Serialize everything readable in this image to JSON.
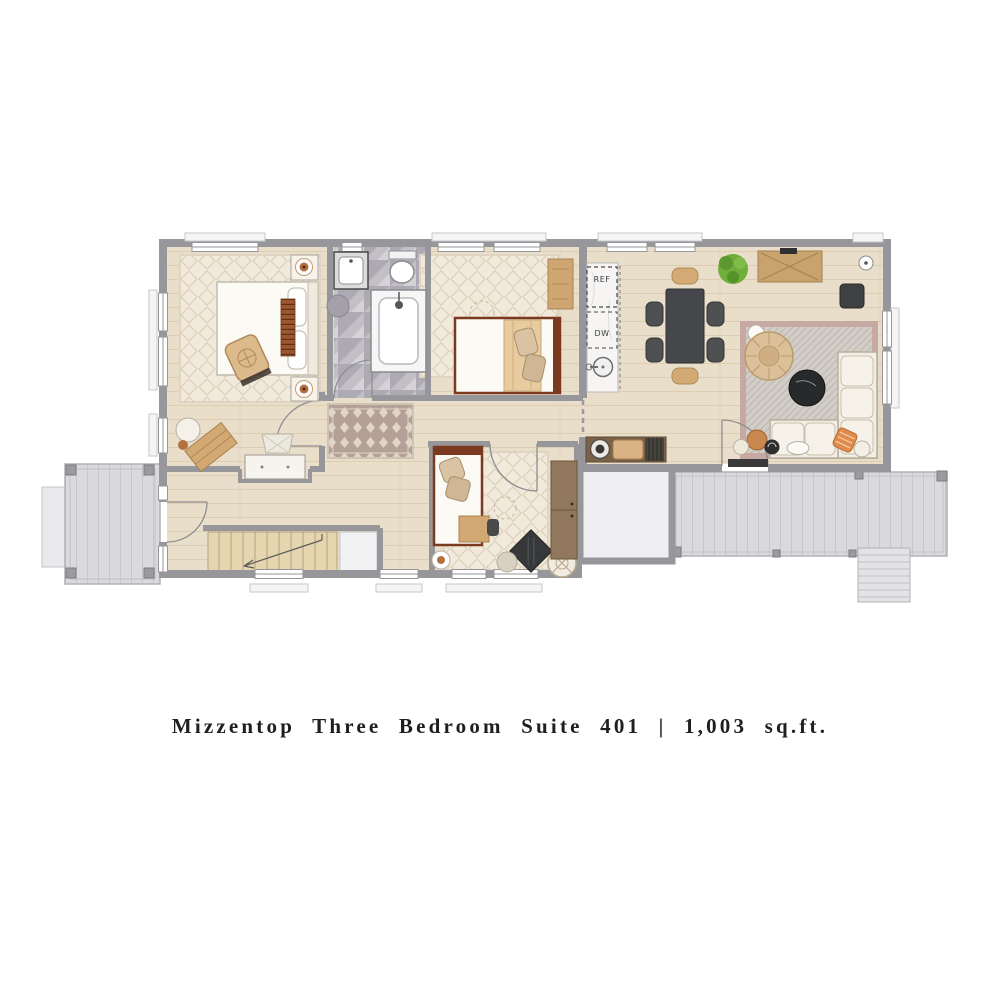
{
  "caption": {
    "text": "Mizzentop Three Bedroom Suite 401 | 1,003 sq.ft."
  },
  "kitchen": {
    "ref_label": "REF",
    "dw_label": "DW"
  },
  "colors": {
    "background": "#ffffff",
    "wall": "#97969a",
    "floor_wood": "#e9dec9",
    "bath_tile": "#c2bfc5",
    "rug_cream": "#f1e9da",
    "runner_mauve": "#b3a096",
    "living_rug_border": "#c7a9a3",
    "dining_table": "#45474a",
    "wood_furniture": "#d2a873",
    "bed_frame": "#7b3a20",
    "porch_deck": "#dadade",
    "plant_green": "#6fae3a",
    "terracotta": "#b4713f",
    "caption_text": "#1f1f1f"
  }
}
